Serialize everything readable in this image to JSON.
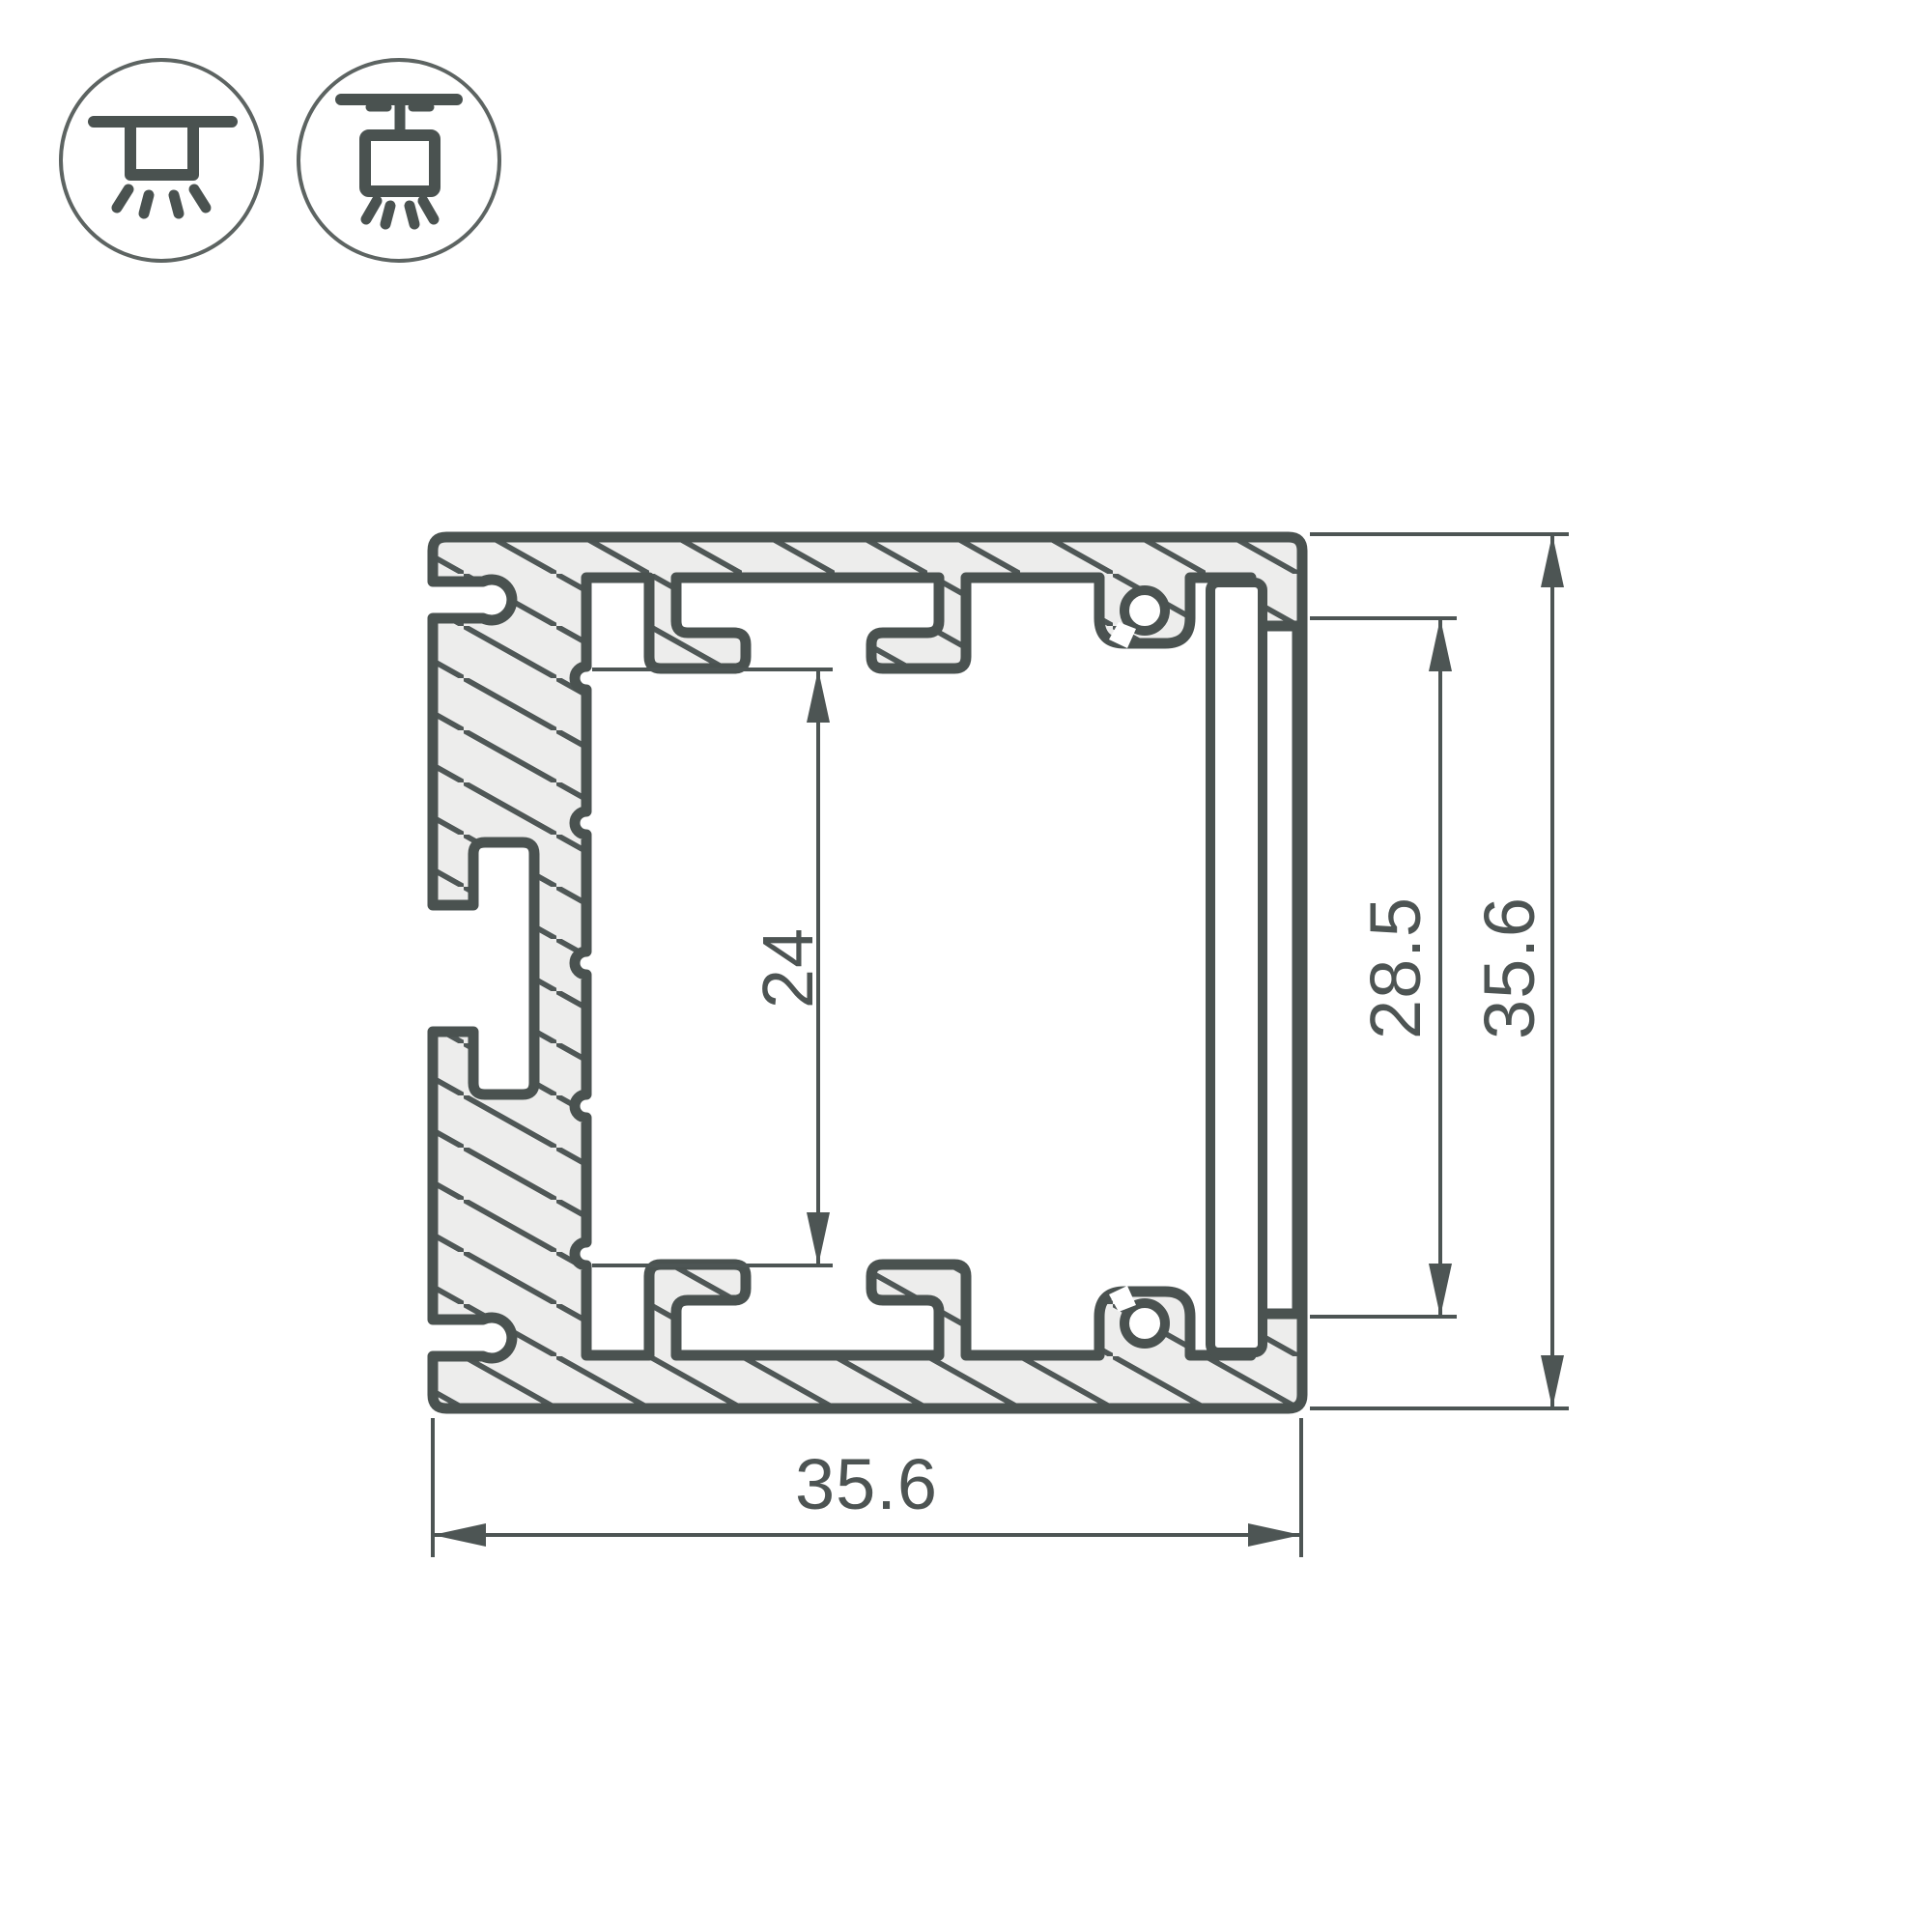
{
  "drawing": {
    "type": "aluminium-led-profile-cross-section",
    "dimensions": {
      "overall_width": "35.6",
      "overall_height": "35.6",
      "diffuser_opening": "28.5",
      "inner_cavity": "24"
    },
    "colors": {
      "outline": "#4a5250",
      "hatch_line": "#4f5756",
      "metal_fill": "#ededec",
      "dimension_line": "#4d5554",
      "text": "#4d5453",
      "icon_circle": "#5d6462",
      "background": "#ffffff"
    },
    "icons": [
      {
        "name": "surface-mounted-luminaire"
      },
      {
        "name": "suspended-luminaire"
      }
    ]
  }
}
